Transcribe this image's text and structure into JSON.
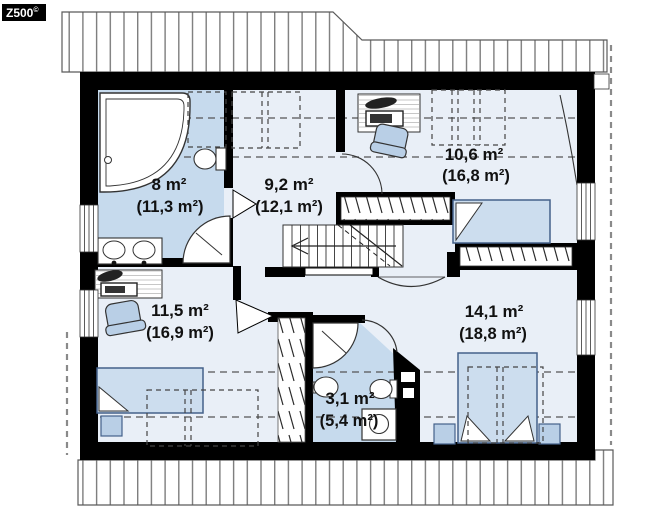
{
  "logo": {
    "brand": "Z500",
    "mark": "©"
  },
  "plan_title": "attic floor plan",
  "rooms": {
    "bath_top": {
      "area": "8 m²",
      "gross": "(11,3 m²)"
    },
    "hall": {
      "area": "9,2 m²",
      "gross": "(12,1 m²)"
    },
    "bedroom_right": {
      "area": "10,6 m²",
      "gross": "(16,8 m²)"
    },
    "bedroom_left": {
      "area": "11,5 m²",
      "gross": "(16,9 m²)"
    },
    "bedroom_master": {
      "area": "14,1 m²",
      "gross": "(18,8 m²)"
    },
    "bath_bottom": {
      "area": "3,1 m²",
      "gross": "(5,4 m²)"
    }
  },
  "colors": {
    "wall": "#000000",
    "bath_fill": "#c6daed",
    "room_fill": "#e9eff7",
    "bed_fill": "#ccddee",
    "chair_fill": "#b9cfe6",
    "furniture_stroke": "#44618a",
    "roof_stripe": "#7d7d7d",
    "dash_line": "#555555"
  }
}
